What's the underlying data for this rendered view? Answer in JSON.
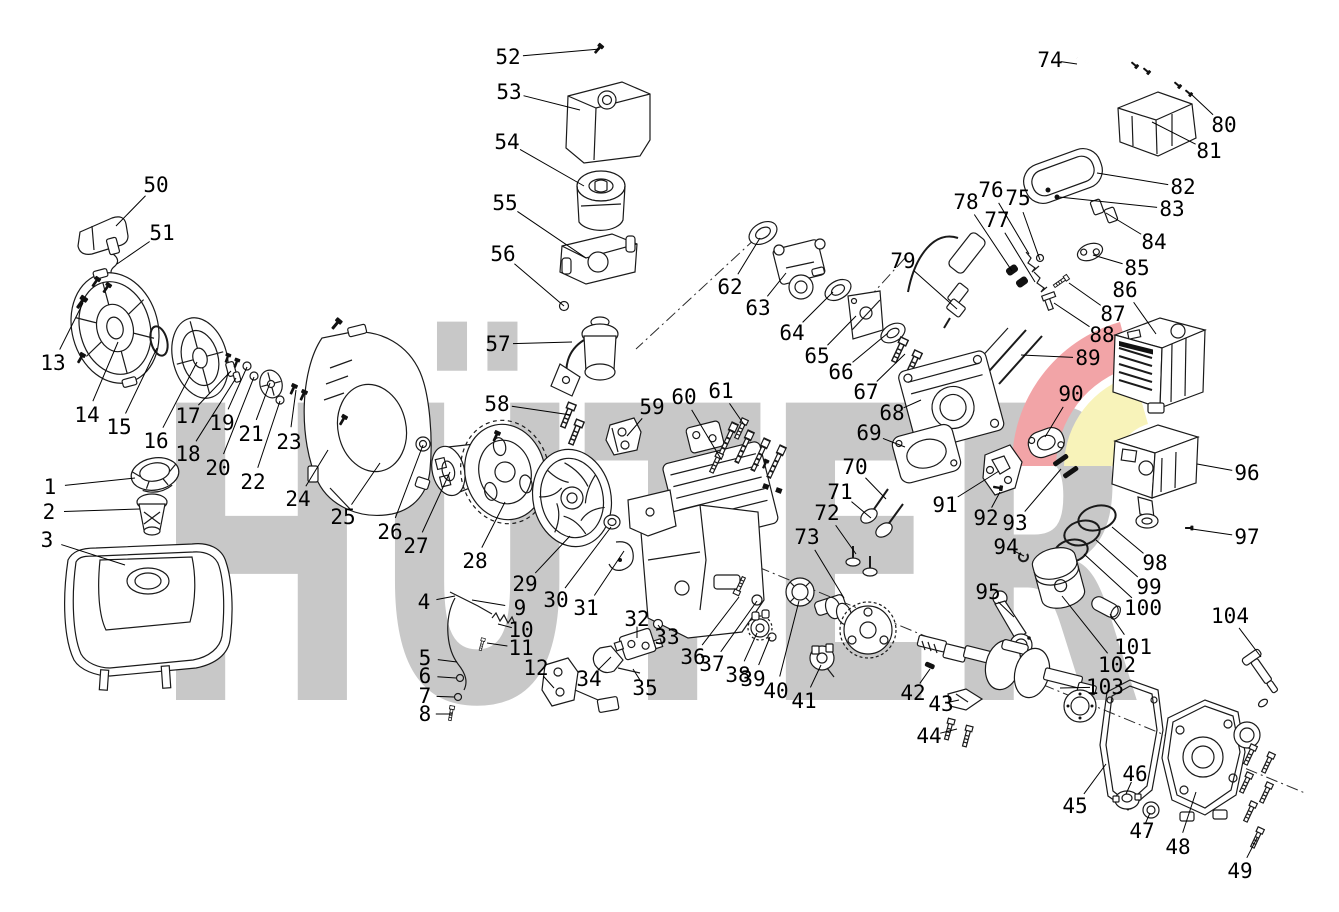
{
  "canvas": {
    "width": 1339,
    "height": 912,
    "background": "#ffffff"
  },
  "watermark": {
    "text": "HÜTER",
    "color": "#c8c8c8",
    "swoosh_red": "#f2a4a7",
    "swoosh_yellow": "#f8f3ba"
  },
  "figure": {
    "kind": "exploded-parts-diagram"
  },
  "labels": [
    {
      "n": "1",
      "x": 50,
      "y": 487,
      "tx": 135,
      "ty": 478
    },
    {
      "n": "2",
      "x": 49,
      "y": 512,
      "tx": 140,
      "ty": 509
    },
    {
      "n": "3",
      "x": 47,
      "y": 540,
      "tx": 125,
      "ty": 565
    },
    {
      "n": "4",
      "x": 424,
      "y": 602,
      "tx": 455,
      "ty": 596
    },
    {
      "n": "5",
      "x": 425,
      "y": 658,
      "tx": 457,
      "ty": 662
    },
    {
      "n": "6",
      "x": 425,
      "y": 676,
      "tx": 456,
      "ty": 678
    },
    {
      "n": "7",
      "x": 425,
      "y": 696,
      "tx": 454,
      "ty": 697
    },
    {
      "n": "8",
      "x": 425,
      "y": 714,
      "tx": 452,
      "ty": 714
    },
    {
      "n": "9",
      "x": 520,
      "y": 608,
      "tx": 472,
      "ty": 600
    },
    {
      "n": "10",
      "x": 521,
      "y": 630,
      "tx": 498,
      "ty": 624
    },
    {
      "n": "11",
      "x": 521,
      "y": 648,
      "tx": 487,
      "ty": 643
    },
    {
      "n": "12",
      "x": 536,
      "y": 668,
      "tx": 554,
      "ty": 688
    },
    {
      "n": "13",
      "x": 53,
      "y": 363,
      "tx": 83,
      "ty": 303
    },
    {
      "n": "14",
      "x": 87,
      "y": 415,
      "tx": 118,
      "ty": 342
    },
    {
      "n": "15",
      "x": 119,
      "y": 427,
      "tx": 157,
      "ty": 348
    },
    {
      "n": "16",
      "x": 156,
      "y": 441,
      "tx": 197,
      "ty": 362
    },
    {
      "n": "17",
      "x": 188,
      "y": 416,
      "tx": 231,
      "ty": 371
    },
    {
      "n": "18",
      "x": 188,
      "y": 454,
      "tx": 236,
      "ty": 378
    },
    {
      "n": "19",
      "x": 222,
      "y": 423,
      "tx": 247,
      "ty": 367
    },
    {
      "n": "20",
      "x": 218,
      "y": 468,
      "tx": 254,
      "ty": 377
    },
    {
      "n": "21",
      "x": 251,
      "y": 434,
      "tx": 270,
      "ty": 383
    },
    {
      "n": "22",
      "x": 253,
      "y": 482,
      "tx": 280,
      "ty": 401
    },
    {
      "n": "23",
      "x": 289,
      "y": 442,
      "tx": 296,
      "ty": 390
    },
    {
      "n": "24",
      "x": 298,
      "y": 499,
      "tx": 328,
      "ty": 450
    },
    {
      "n": "25",
      "x": 343,
      "y": 517,
      "tx": 380,
      "ty": 463
    },
    {
      "n": "26",
      "x": 390,
      "y": 532,
      "tx": 423,
      "ty": 445
    },
    {
      "n": "27",
      "x": 416,
      "y": 546,
      "tx": 450,
      "ty": 472
    },
    {
      "n": "28",
      "x": 475,
      "y": 561,
      "tx": 505,
      "ty": 502
    },
    {
      "n": "29",
      "x": 525,
      "y": 584,
      "tx": 570,
      "ty": 536
    },
    {
      "n": "30",
      "x": 556,
      "y": 600,
      "tx": 611,
      "ty": 527
    },
    {
      "n": "31",
      "x": 586,
      "y": 608,
      "tx": 624,
      "ty": 551
    },
    {
      "n": "32",
      "x": 637,
      "y": 619,
      "tx": 637,
      "ty": 638
    },
    {
      "n": "33",
      "x": 667,
      "y": 637,
      "tx": 658,
      "ty": 625
    },
    {
      "n": "34",
      "x": 589,
      "y": 679,
      "tx": 611,
      "ty": 657
    },
    {
      "n": "35",
      "x": 645,
      "y": 688,
      "tx": 633,
      "ty": 669
    },
    {
      "n": "36",
      "x": 693,
      "y": 657,
      "tx": 739,
      "ty": 597
    },
    {
      "n": "37",
      "x": 712,
      "y": 664,
      "tx": 757,
      "ty": 601
    },
    {
      "n": "38",
      "x": 738,
      "y": 675,
      "tx": 757,
      "ty": 633
    },
    {
      "n": "39",
      "x": 753,
      "y": 679,
      "tx": 770,
      "ty": 637
    },
    {
      "n": "40",
      "x": 776,
      "y": 691,
      "tx": 799,
      "ty": 601
    },
    {
      "n": "41",
      "x": 804,
      "y": 701,
      "tx": 821,
      "ty": 665
    },
    {
      "n": "42",
      "x": 913,
      "y": 693,
      "tx": 930,
      "ty": 669
    },
    {
      "n": "43",
      "x": 941,
      "y": 704,
      "tx": 959,
      "ty": 700
    },
    {
      "n": "44",
      "x": 929,
      "y": 736,
      "tx": 957,
      "ty": 729
    },
    {
      "n": "45",
      "x": 1075,
      "y": 806,
      "tx": 1106,
      "ty": 764
    },
    {
      "n": "46",
      "x": 1135,
      "y": 774,
      "tx": 1126,
      "ty": 794
    },
    {
      "n": "47",
      "x": 1142,
      "y": 831,
      "tx": 1150,
      "ty": 813
    },
    {
      "n": "48",
      "x": 1178,
      "y": 847,
      "tx": 1196,
      "ty": 792
    },
    {
      "n": "49",
      "x": 1240,
      "y": 871,
      "tx": 1257,
      "ty": 838
    },
    {
      "n": "50",
      "x": 156,
      "y": 185,
      "tx": 116,
      "ty": 226
    },
    {
      "n": "51",
      "x": 162,
      "y": 233,
      "tx": 117,
      "ty": 264
    },
    {
      "n": "52",
      "x": 508,
      "y": 57,
      "tx": 600,
      "ty": 49
    },
    {
      "n": "53",
      "x": 509,
      "y": 92,
      "tx": 580,
      "ty": 110
    },
    {
      "n": "54",
      "x": 507,
      "y": 142,
      "tx": 584,
      "ty": 186
    },
    {
      "n": "55",
      "x": 505,
      "y": 203,
      "tx": 586,
      "ty": 258
    },
    {
      "n": "56",
      "x": 503,
      "y": 254,
      "tx": 564,
      "ty": 306
    },
    {
      "n": "57",
      "x": 498,
      "y": 344,
      "tx": 572,
      "ty": 342
    },
    {
      "n": "58",
      "x": 497,
      "y": 404,
      "tx": 571,
      "ty": 415
    },
    {
      "n": "59",
      "x": 652,
      "y": 407,
      "tx": 627,
      "ty": 436
    },
    {
      "n": "60",
      "x": 684,
      "y": 397,
      "tx": 721,
      "ty": 459
    },
    {
      "n": "61",
      "x": 721,
      "y": 391,
      "tx": 745,
      "ty": 426
    },
    {
      "n": "62",
      "x": 730,
      "y": 287,
      "tx": 760,
      "ty": 238
    },
    {
      "n": "63",
      "x": 758,
      "y": 308,
      "tx": 786,
      "ty": 273
    },
    {
      "n": "64",
      "x": 792,
      "y": 333,
      "tx": 833,
      "ty": 292
    },
    {
      "n": "65",
      "x": 817,
      "y": 356,
      "tx": 856,
      "ty": 316
    },
    {
      "n": "66",
      "x": 841,
      "y": 372,
      "tx": 888,
      "ty": 333
    },
    {
      "n": "67",
      "x": 866,
      "y": 392,
      "tx": 905,
      "ty": 354
    },
    {
      "n": "68",
      "x": 892,
      "y": 413,
      "tx": 921,
      "ty": 400
    },
    {
      "n": "69",
      "x": 869,
      "y": 433,
      "tx": 905,
      "ty": 447
    },
    {
      "n": "70",
      "x": 855,
      "y": 467,
      "tx": 886,
      "ty": 499
    },
    {
      "n": "71",
      "x": 840,
      "y": 492,
      "tx": 871,
      "ty": 518
    },
    {
      "n": "72",
      "x": 827,
      "y": 513,
      "tx": 856,
      "ty": 554
    },
    {
      "n": "73",
      "x": 807,
      "y": 537,
      "tx": 844,
      "ty": 598
    },
    {
      "n": "74",
      "x": 1050,
      "y": 60,
      "tx": 1077,
      "ty": 64
    },
    {
      "n": "75",
      "x": 1018,
      "y": 198,
      "tx": 1040,
      "ty": 260
    },
    {
      "n": "76",
      "x": 991,
      "y": 190,
      "tx": 1029,
      "ty": 254
    },
    {
      "n": "77",
      "x": 997,
      "y": 220,
      "tx": 1035,
      "ty": 282
    },
    {
      "n": "78",
      "x": 966,
      "y": 202,
      "tx": 1012,
      "ty": 271
    },
    {
      "n": "79",
      "x": 903,
      "y": 261,
      "tx": 957,
      "ty": 309
    },
    {
      "n": "80",
      "x": 1224,
      "y": 125,
      "tx": 1191,
      "ty": 94
    },
    {
      "n": "81",
      "x": 1209,
      "y": 151,
      "tx": 1152,
      "ty": 122
    },
    {
      "n": "82",
      "x": 1183,
      "y": 187,
      "tx": 1097,
      "ty": 173
    },
    {
      "n": "83",
      "x": 1172,
      "y": 209,
      "tx": 1059,
      "ty": 197
    },
    {
      "n": "84",
      "x": 1154,
      "y": 242,
      "tx": 1106,
      "ty": 213
    },
    {
      "n": "85",
      "x": 1137,
      "y": 268,
      "tx": 1093,
      "ty": 255
    },
    {
      "n": "86",
      "x": 1125,
      "y": 290,
      "tx": 1156,
      "ty": 334
    },
    {
      "n": "87",
      "x": 1113,
      "y": 314,
      "tx": 1069,
      "ty": 283
    },
    {
      "n": "88",
      "x": 1102,
      "y": 335,
      "tx": 1054,
      "ty": 303
    },
    {
      "n": "89",
      "x": 1088,
      "y": 358,
      "tx": 1021,
      "ty": 355
    },
    {
      "n": "90",
      "x": 1071,
      "y": 394,
      "tx": 1045,
      "ty": 437
    },
    {
      "n": "91",
      "x": 945,
      "y": 505,
      "tx": 999,
      "ty": 471
    },
    {
      "n": "92",
      "x": 986,
      "y": 518,
      "tx": 1000,
      "ty": 492
    },
    {
      "n": "93",
      "x": 1015,
      "y": 523,
      "tx": 1061,
      "ty": 469
    },
    {
      "n": "94",
      "x": 1006,
      "y": 547,
      "tx": 1024,
      "ty": 556
    },
    {
      "n": "95",
      "x": 988,
      "y": 592,
      "tx": 1014,
      "ty": 617
    },
    {
      "n": "96",
      "x": 1247,
      "y": 473,
      "tx": 1197,
      "ty": 464
    },
    {
      "n": "97",
      "x": 1247,
      "y": 537,
      "tx": 1192,
      "ty": 529
    },
    {
      "n": "98",
      "x": 1155,
      "y": 563,
      "tx": 1112,
      "ty": 527
    },
    {
      "n": "99",
      "x": 1149,
      "y": 587,
      "tx": 1096,
      "ty": 540
    },
    {
      "n": "100",
      "x": 1143,
      "y": 608,
      "tx": 1084,
      "ty": 554
    },
    {
      "n": "101",
      "x": 1133,
      "y": 647,
      "tx": 1110,
      "ty": 614
    },
    {
      "n": "102",
      "x": 1117,
      "y": 665,
      "tx": 1062,
      "ty": 596
    },
    {
      "n": "103",
      "x": 1105,
      "y": 687,
      "tx": 1060,
      "ty": 688
    },
    {
      "n": "104",
      "x": 1230,
      "y": 616,
      "tx": 1261,
      "ty": 657
    }
  ]
}
